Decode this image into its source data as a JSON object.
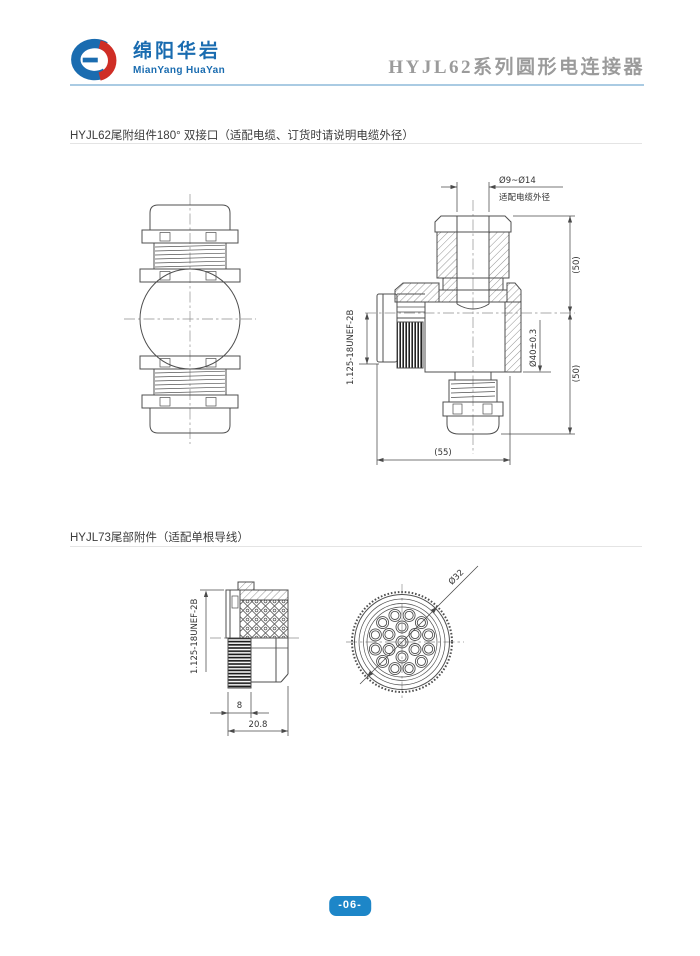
{
  "header": {
    "logo_cn": "绵阳华岩",
    "logo_en": "MianYang HuaYan",
    "doc_title": "HYJL62系列圆形电连接器"
  },
  "section1": {
    "title": "HYJL62尾附组件180° 双接口（适配电缆、订货时请说明电缆外径）",
    "drawing": {
      "cable_range": "Ø9~Ø14",
      "cable_note": "适配电缆外径",
      "height_upper": "(50)",
      "height_lower": "(50)",
      "body_dia": "Ø40±0.3",
      "overall_width": "(55)",
      "thread_spec": "1.125-18UNEF-2B"
    }
  },
  "section2": {
    "title": "HYJL73尾部附件（适配单根导线）",
    "drawing": {
      "thread_spec": "1.125-18UNEF-2B",
      "nut_length": "8",
      "overall_length": "20.8",
      "face_dia": "Ø32"
    }
  },
  "footer": {
    "page_number": "-06-"
  },
  "colors": {
    "brand_blue": "#1a6cb0",
    "brand_red": "#cf2e26",
    "header_rule": "#aacbe3",
    "section_rule": "#e4e4e4",
    "badge_bg": "#1d86c8",
    "title_gray": "#9b9b9b",
    "drawing_line": "#4a4a4a"
  }
}
